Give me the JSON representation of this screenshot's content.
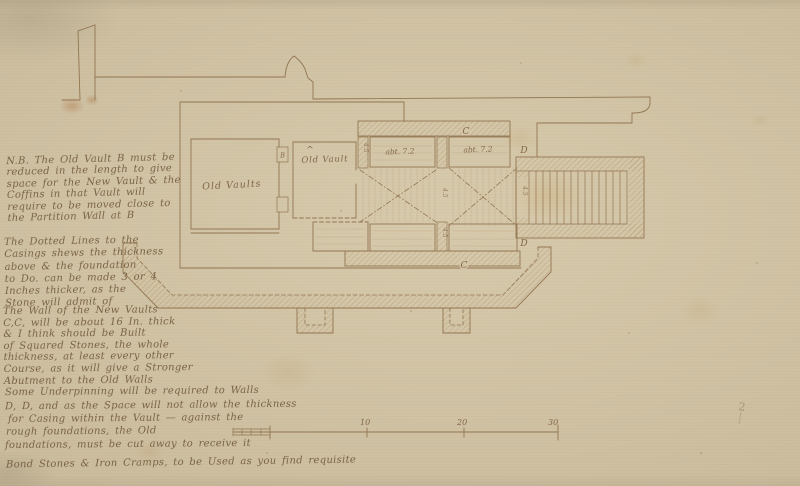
{
  "annotations": {
    "nb_note": [
      "N.B. The Old Vault B must be",
      "reduced in the length to give",
      "space for the New Vault & the",
      "Coffins in that Vault will",
      "require to be moved close to",
      "the Partition Wall at B"
    ],
    "dotted_lines_note": [
      "The Dotted Lines to the",
      "Casings shews the thickness",
      "above & the foundation",
      "to Do. can be made 3 or 4",
      "Inches thicker, as the",
      "Stone will admit of"
    ],
    "new_wall_note": [
      "The Wall of the New Vaults",
      "C,C, will be about 16 In. thick",
      "& I think should be Built",
      "of Squared Stones, the whole",
      "thickness, at least every other",
      "Course, as it will give a Stronger",
      "Abutment to the Old Walls"
    ],
    "underpinning_note": [
      "Some Underpinning will be required to Walls",
      "D, D, and as the Space will not allow the thickness",
      "for Casing within the Vault — against the",
      "rough foundations, the Old",
      "foundations, must be cut away to receive it"
    ],
    "closing_note": "Bond Stones & Iron Cramps, to be Used as you find requisite"
  },
  "plan": {
    "room_labels": {
      "left_vault": "Old Vaults",
      "middle_vault": "Old Vault",
      "caret_mark": "^"
    },
    "bay_labels": {
      "left": "abt. 7.2",
      "right": "abt. 7.2"
    },
    "reference_letters": {
      "b": "B",
      "c_top": "C",
      "c_bottom": "C",
      "d_top": "D",
      "d_bottom": "D"
    },
    "dimension_marks": {
      "pier_left": "4.5",
      "pier_center": "4.5",
      "pier_center_lower": "4.5",
      "stair_side": "4.5"
    }
  },
  "scale_bar": {
    "tick_labels": [
      "10",
      "20",
      "30"
    ]
  },
  "pencil_mark": "2",
  "colors": {
    "paper": "#d3c5a6",
    "ink": "#8b6d4a",
    "handwriting": "#70563a"
  }
}
